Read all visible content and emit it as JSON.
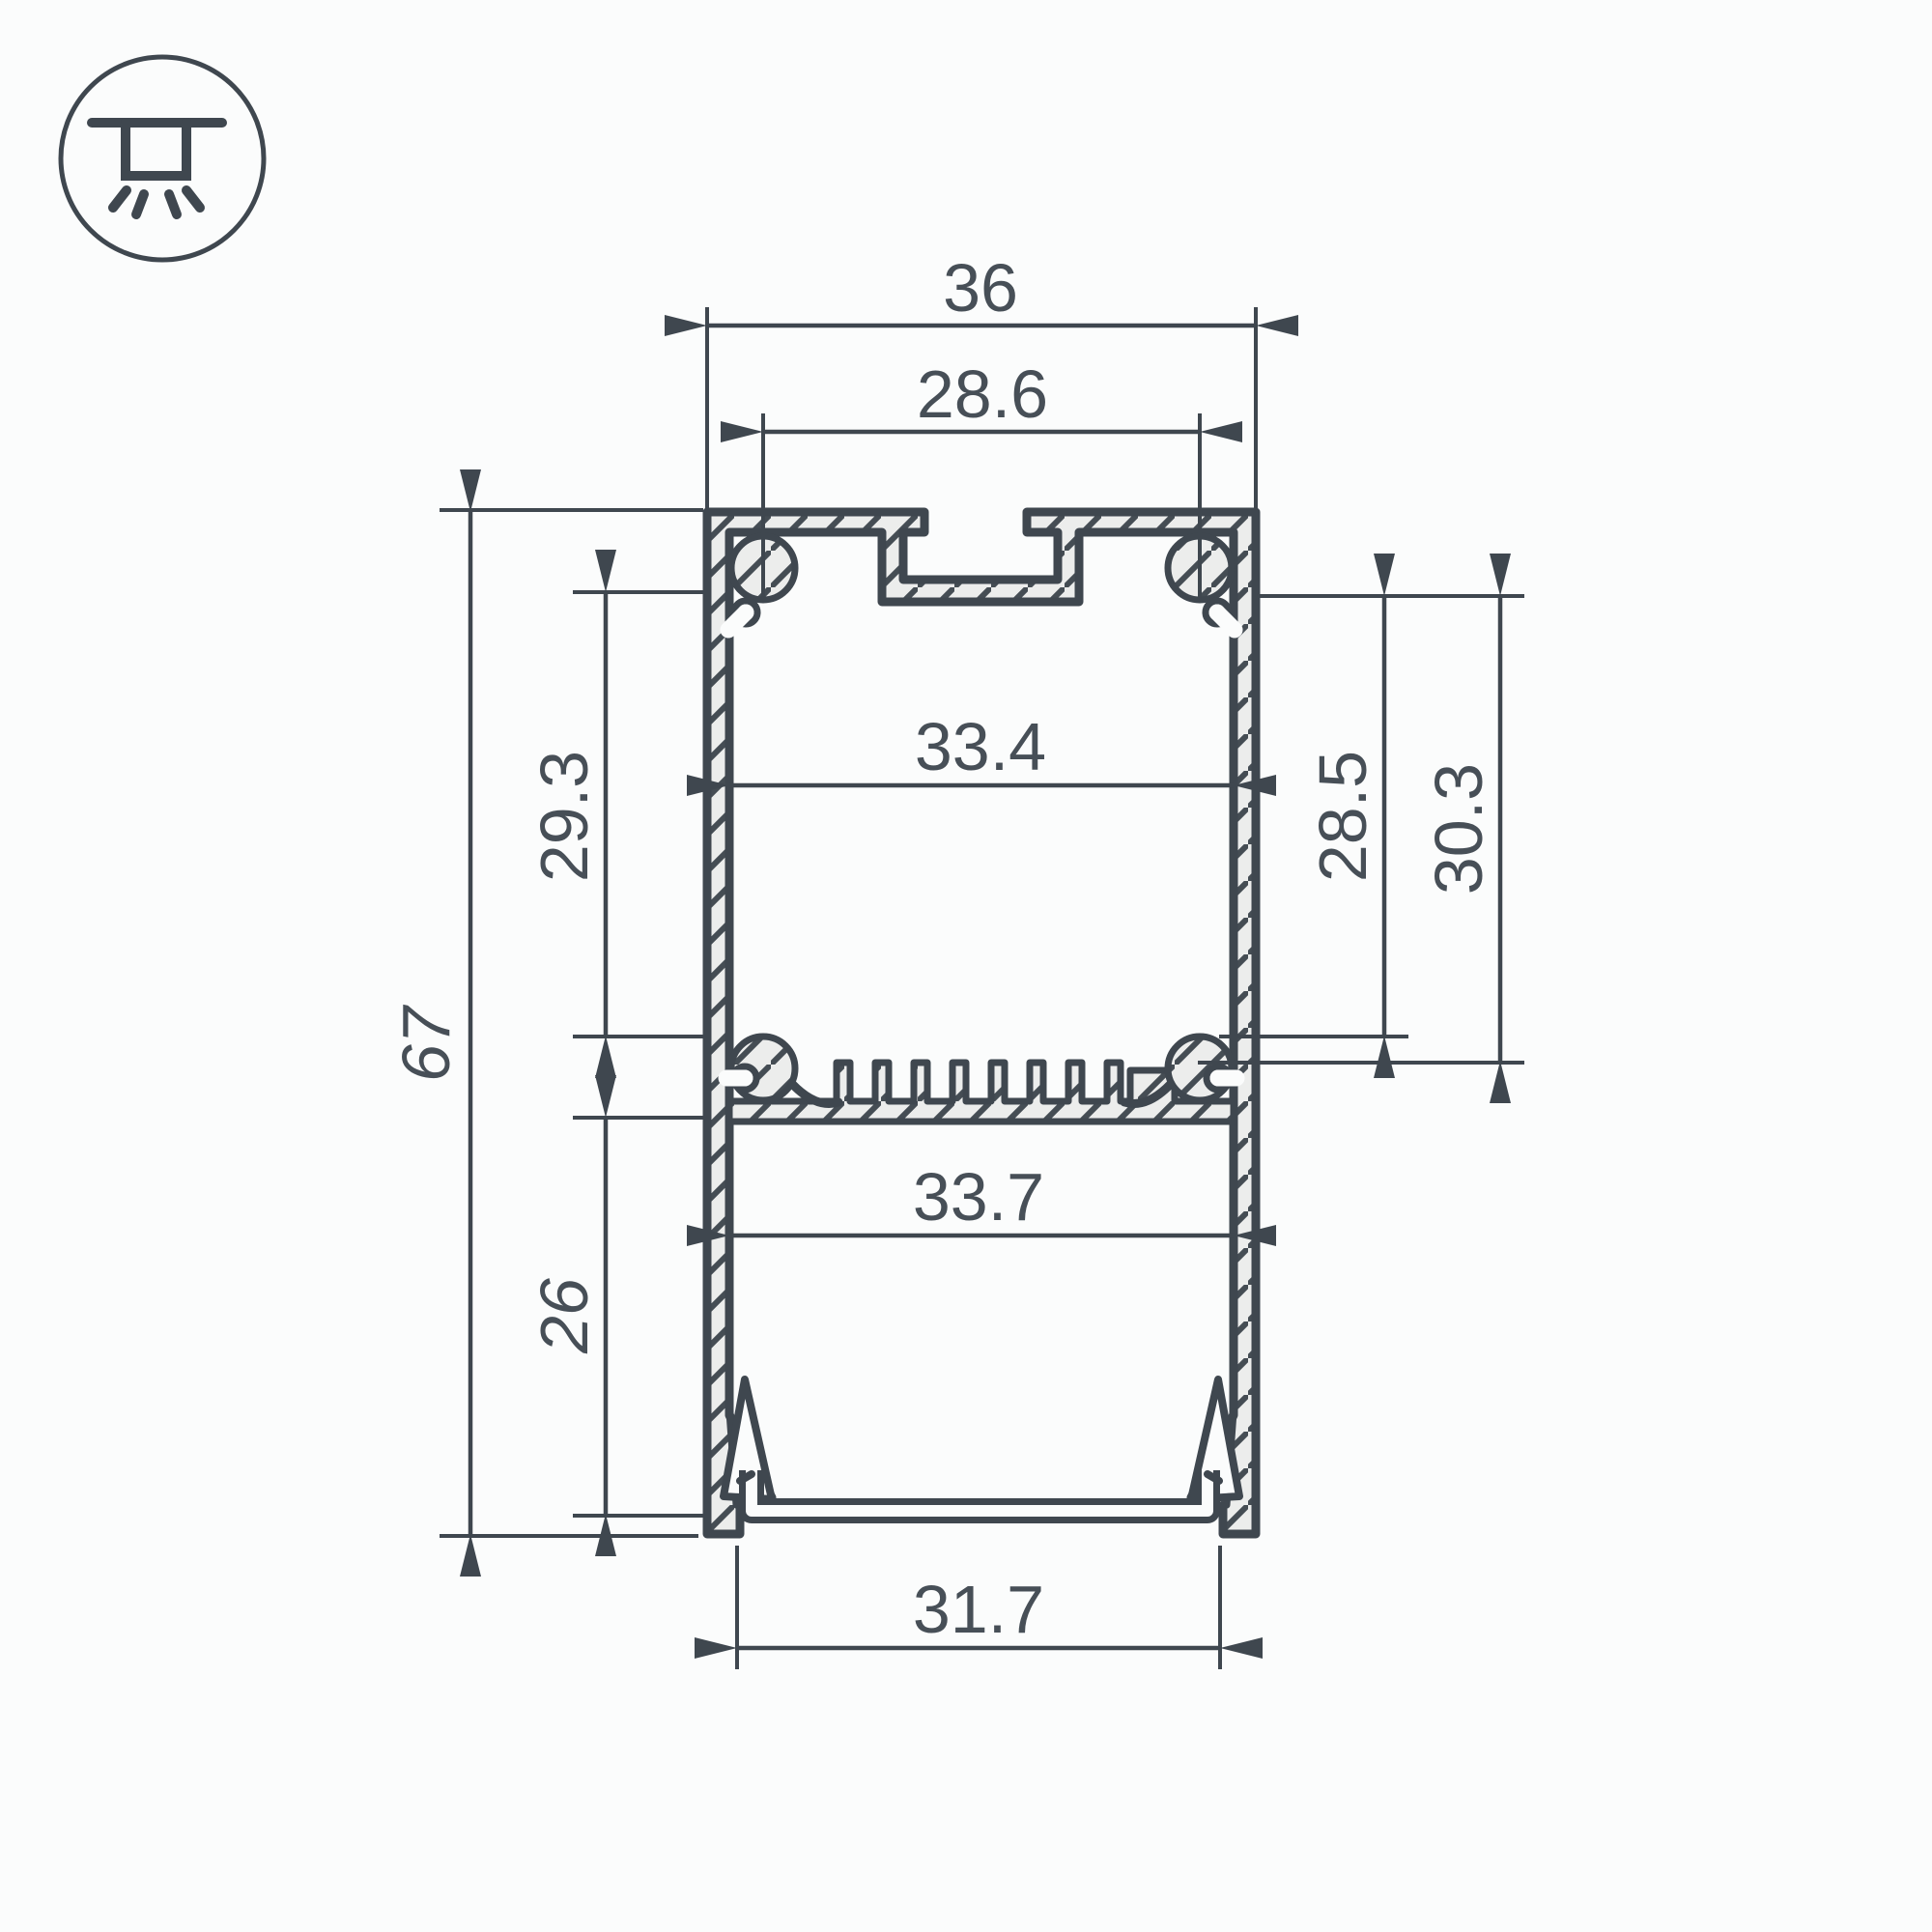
{
  "title": "aluminium-led-profile-cross-section-drawing",
  "icon": {
    "meaning": "recessed-ceiling-light-icon"
  },
  "dims": {
    "total_width": "36",
    "slot_spacing": "28.6",
    "upper_inner_width": "33.4",
    "upper_chamber_height": "29.3",
    "total_height": "67",
    "lower_chamber_height": "26",
    "right_inner_height": "28.5",
    "right_outer_height": "30.3",
    "lower_inner_width": "33.7",
    "bottom_opening_width": "31.7"
  },
  "colors": {
    "line": "#3f474f",
    "material_fill": "#ecedec",
    "text": "#474f57",
    "background": "#fbfcfc"
  }
}
